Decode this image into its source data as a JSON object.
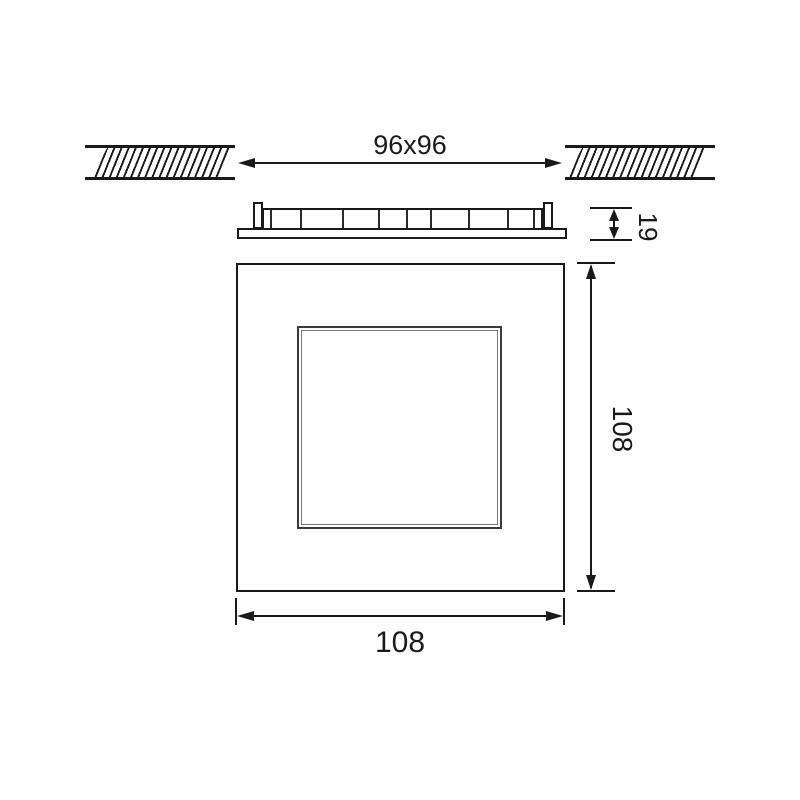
{
  "colors": {
    "line": "#1a1a1a",
    "inner_frame_outer": "#3a3a3a",
    "inner_frame_inner": "#787878",
    "background": "#ffffff"
  },
  "views": {
    "ceiling_cutout": {
      "dimension_label": "96x96"
    },
    "side_profile": {
      "height_label": "19"
    },
    "front_view": {
      "face_height_label": "108",
      "face_width_label": "108"
    }
  }
}
